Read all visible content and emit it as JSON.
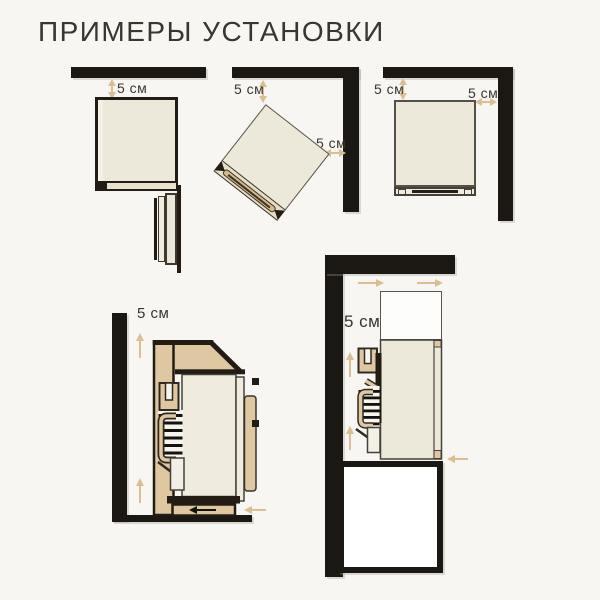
{
  "title": "ПРИМЕРЫ УСТАНОВКИ",
  "colors": {
    "bg": "#f7f6f3",
    "wall": "#1b1712",
    "ink": "#221c15",
    "paper": "#ece9db",
    "tan": "#dfc7a1",
    "arrow": "#d9bf92",
    "text": "#3a352d",
    "white": "#ffffff"
  },
  "diagrams": {
    "top_wall": {
      "gap_top": "5 см"
    },
    "corner_angled": {
      "gap_top": "5 см",
      "gap_right": "5 см"
    },
    "corner_straight": {
      "gap_top": "5 см",
      "gap_right": "5 см"
    },
    "side_wall": {
      "gap": "5 см"
    },
    "side_builtin": {
      "gap": "5 см"
    }
  }
}
